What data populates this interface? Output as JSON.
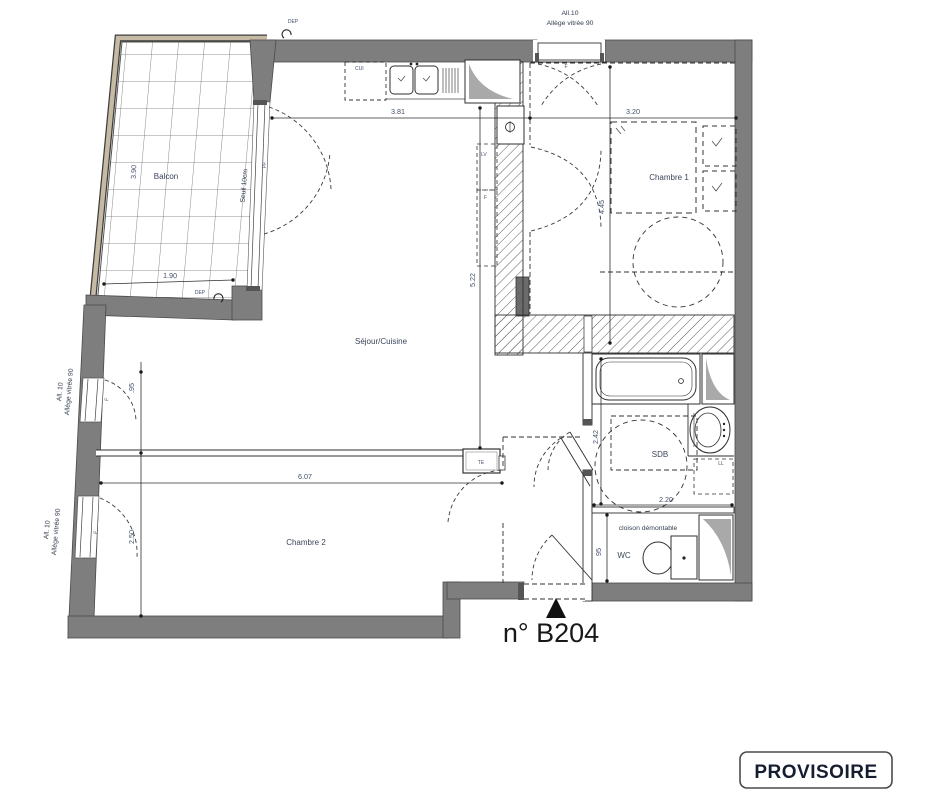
{
  "title": {
    "unit": "n° B204",
    "stamp": "PROVISOIRE"
  },
  "rooms": {
    "balcony": "Balcon",
    "living": "Séjour/Cuisine",
    "bedroom1": "Chambre 1",
    "bedroom2": "Chambre 2",
    "bathroom": "SDB",
    "wc": "WC"
  },
  "windows": {
    "top": {
      "l1": "All.10",
      "l2": "Allège vitrée 90",
      "leaf": "F"
    },
    "left_upper": {
      "l1": "All. 10",
      "l2": "Allège vitrée 90",
      "leaf": "F"
    },
    "left_lower": {
      "l1": "All. 10",
      "l2": "Allège vitrée 90",
      "leaf": "F"
    },
    "balcony_door": {
      "label": "PF",
      "threshold": "Seuil 10cm"
    }
  },
  "equipment": {
    "kitchen_zone": "CUI",
    "dishwasher": "LV",
    "fridge": "F",
    "electrical_panel": "TE",
    "washing_machine": "LL",
    "partition_note": "cloison démontable",
    "duct_top": "DEP",
    "duct_balcony": "DEP"
  },
  "dimensions": {
    "living_width": "3.81",
    "bedroom1_width": "3.20",
    "bedroom1_depth": "4.45",
    "living_depth": "5.22",
    "bedroom2_width": "6.07",
    "bedroom2_depth": "2.50",
    "balcony_depth": "3.90",
    "balcony_width": "1.90",
    "facade_offset": ".95",
    "bathroom_depth": "2.42",
    "bathroom_width": "2.20",
    "wc_width": "95"
  },
  "colors": {
    "wall": "#7e7e7e",
    "railing": "#c6baa4",
    "hatch": "#5f5f5f",
    "line": "#2f2f2f",
    "dim_text": "#42506a",
    "paper": "#ffffff"
  }
}
